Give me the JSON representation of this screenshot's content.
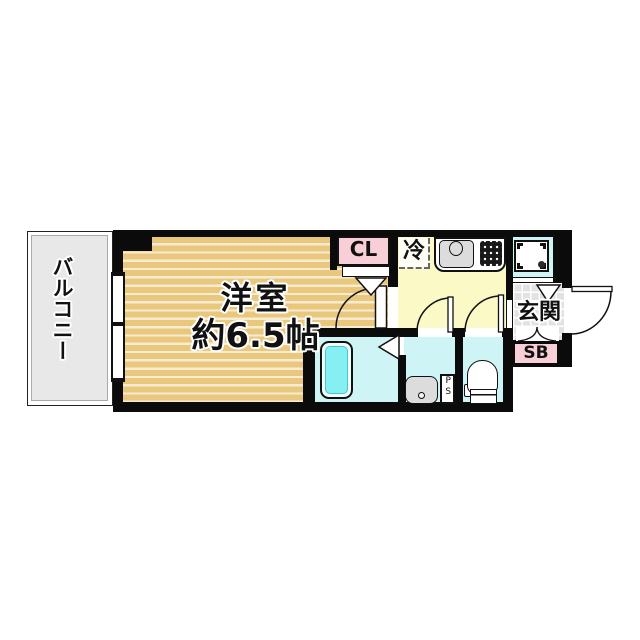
{
  "floorplan": {
    "labels": {
      "balcony": "バルコニー",
      "room_name": "洋室",
      "room_size": "約6.5帖",
      "closet": "CL",
      "fridge": "冷",
      "entrance": "玄関",
      "shoebox": "SB",
      "pipe_space": "PS"
    },
    "colors": {
      "wall": "#0b0b0b",
      "room": "#e9c87e",
      "stripe": "#f5ecd3",
      "kitchen": "#fbf9c6",
      "wet": "#cff4f6",
      "tub": "#86eff1",
      "pink": "#f8cfd7",
      "tile": "#e2e2e2",
      "balcony": "#e8e8e8",
      "fixture_gray": "#dcdcdc"
    }
  }
}
